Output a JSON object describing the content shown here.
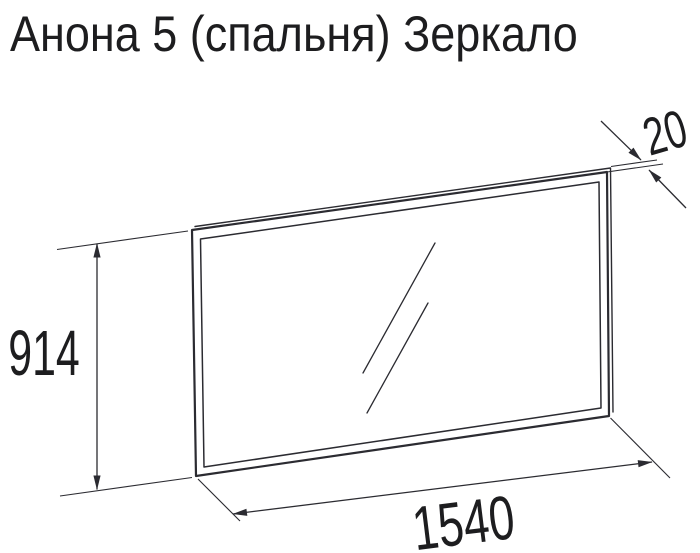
{
  "title": "Анона 5 (спальня) Зеркало",
  "drawing": {
    "type": "furniture-technical-drawing",
    "depicted_part": "Зеркало"
  },
  "dimensions": {
    "height": {
      "value": 914,
      "label": "914"
    },
    "width": {
      "value": 1540,
      "label": "1540"
    },
    "depth": {
      "value": 20,
      "label": "20"
    }
  },
  "colors": {
    "background": "#ffffff",
    "line": "#2b2b31",
    "text": "#1d1d1f"
  }
}
